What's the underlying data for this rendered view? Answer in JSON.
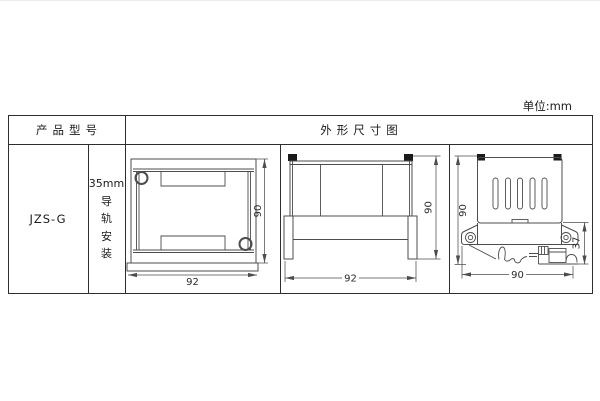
{
  "unit_label": "单位:mm",
  "table": {
    "header_product_model": "产品型号",
    "header_dimension_diagram": "外形尺寸图",
    "product_model": "JZS-G",
    "mounting": {
      "size": "35mm",
      "chars": [
        "导",
        "轨",
        "安",
        "装"
      ]
    }
  },
  "dimensions": {
    "top_view": {
      "width": "92",
      "height": "90"
    },
    "front_view": {
      "width": "92",
      "height": "90"
    },
    "side_view": {
      "height": "90",
      "width": "90",
      "clip_depth": "37"
    }
  }
}
